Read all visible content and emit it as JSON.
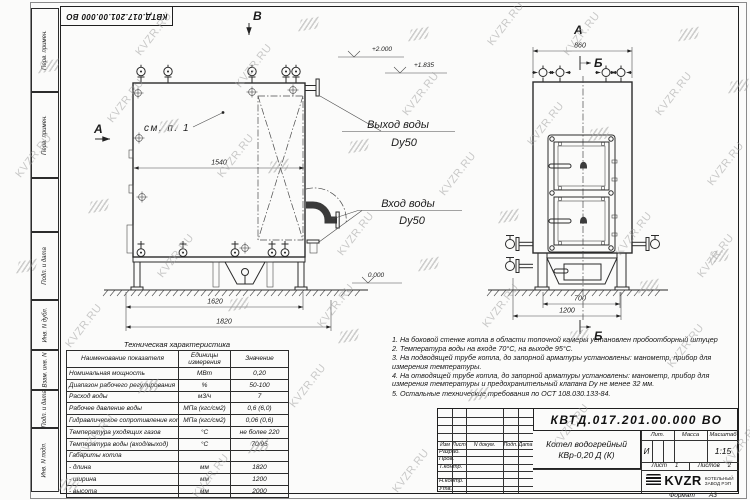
{
  "watermark": {
    "text": "KVZR.RU"
  },
  "frame": {
    "corner_doc_number": "КВТД.017.201.00.000  ВО",
    "strip_labels": [
      "Перв. примен.",
      "Перв. примен.",
      "",
      "Подп. и дата",
      "Инв. N дубл.",
      "Взам. инв. N",
      "Подп. и дата",
      "Инв. N подл."
    ]
  },
  "drawing": {
    "front_view": {
      "section_mark_top": "В",
      "view_mark": "А",
      "callout_see_item": "см. п. 1",
      "dim_inner_width": "1540",
      "dim_frame_width": "1620",
      "dim_overall_length": "1820",
      "outlet_line1": "Выход воды",
      "outlet_line2": "Dy50",
      "inlet_line1": "Вход воды",
      "inlet_line2": "Dy50",
      "elevation_top": "+2.000",
      "elevation_mid": "+1.835",
      "elevation_ground": "0.000"
    },
    "side_view": {
      "view_mark": "А",
      "dim_top_width": "860",
      "section_mark_top": "Б",
      "section_mark_bottom": "Б",
      "dim_base_width": "700",
      "dim_overall_width": "1200"
    }
  },
  "spec_table": {
    "title": "Техническая характеристика",
    "headers": [
      "Наименование показателя",
      "Единицы измерения",
      "Значение"
    ],
    "rows": [
      [
        "Номинальная мощность",
        "МВт",
        "0,20"
      ],
      [
        "Диапазон рабочего регулирования",
        "%",
        "50-100"
      ],
      [
        "Расход воды",
        "м3/ч",
        "7"
      ],
      [
        "Рабочее давление воды",
        "МПа (кгс/см2)",
        "0,6 (6,0)"
      ],
      [
        "Гидравлическое сопротивление котла",
        "МПа (кгс/см2)",
        "0,06 (0,6)"
      ],
      [
        "Температура уходящих газов",
        "°С",
        "не более 220"
      ],
      [
        "Температура воды (вход/выход)",
        "°С",
        "70/95"
      ],
      [
        "Габариты котла",
        "",
        ""
      ],
      [
        "    - длина",
        "мм",
        "1820"
      ],
      [
        "    - ширина",
        "мм",
        "1200"
      ],
      [
        "    - высота",
        "мм",
        "2000"
      ]
    ]
  },
  "notes": [
    "1.  На боковой стенке котла в области топочной камеры установлен пробоотборный штуцер",
    "2.  Температура воды на входе 70°С, на выходе 95°С.",
    "3.  На подводящей трубе котла, до запорной арматуры установлены: манометр, прибор для измерения температуры.",
    "4.  На отводящей трубе котла, до запорной арматуры установлены: манометр, прибор для измерения температуры и предохранительный клапана  Dy не менее 32 мм.",
    "5.  Остальные технические требования по ОСТ  108.030.133-84."
  ],
  "title_block": {
    "doc_number": "КВТД.017.201.00.000  ВО",
    "product_name_1": "Котел водогрейный",
    "product_name_2": "КВр-0,20  Д  (К)",
    "header_cols": [
      "Изм",
      "Лист",
      "N докум.",
      "Подп.",
      "Дата"
    ],
    "row_labels": [
      "Разраб.",
      "Пров.",
      "Т.контр.",
      "",
      "Н.контр.",
      "Утв."
    ],
    "lit_header": "Лит.",
    "lit_value": "И",
    "mass_header": "Масса",
    "scale_header": "Масштаб",
    "scale_value": "1:15",
    "sheet_label": "Лист",
    "sheet_value": "1",
    "sheets_label": "Листов",
    "sheets_value": "2",
    "company_logo": "KVZR",
    "company_name_1": "КОТЕЛЬНЫЙ",
    "company_name_2": "ЗАВОД РЭП",
    "format_label": "Формат",
    "format_value": "А3"
  }
}
